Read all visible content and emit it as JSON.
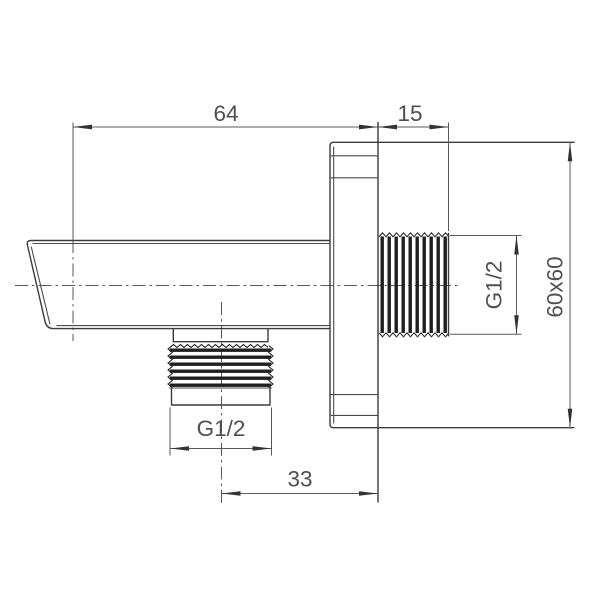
{
  "drawing": {
    "dimensions": {
      "arm_length": "64",
      "wall_thread_length": "15",
      "outlet_offset": "33",
      "outlet_thread": "G1/2",
      "wall_thread": "G1/2",
      "plate_size": "60x60"
    },
    "colors": {
      "part_line": "#3c3c3c",
      "dimension_line": "#5a5a5a",
      "text": "#4f4f4f",
      "thread_fill": "#1f1f1f",
      "background": "#ffffff"
    }
  }
}
